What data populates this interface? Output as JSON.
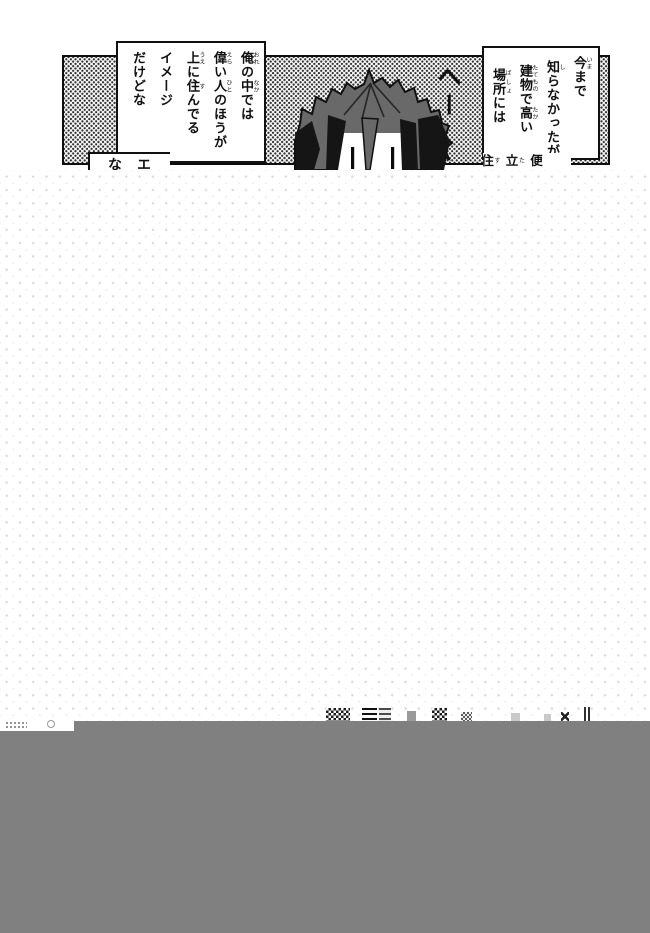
{
  "colors": {
    "gray_bar": "#808080",
    "hair_gray": "#696969",
    "ink": "#111111",
    "tone_dot": "#2e2e2e",
    "overlay_dot": "#dcdcdc",
    "bubble_bg": "#ffffff"
  },
  "bubbles": {
    "right": {
      "columns": [
        {
          "segs": [
            {
              "b": "今",
              "r": "いま"
            },
            {
              "b": "まで"
            }
          ]
        },
        {
          "segs": [
            {
              "b": "知",
              "r": "し"
            },
            {
              "b": "らなかったが"
            }
          ]
        },
        {
          "segs": [
            {
              "b": "建物",
              "r": "たてもの"
            },
            {
              "b": "で"
            },
            {
              "b": "高",
              "r": "たか"
            },
            {
              "b": "い"
            }
          ]
        },
        {
          "segs": [
            {
              "b": "場所",
              "r": "ばしょ"
            },
            {
              "b": "には"
            }
          ]
        }
      ]
    },
    "left": {
      "columns": [
        {
          "segs": [
            {
              "b": "俺",
              "r": "おれ"
            },
            {
              "b": "の"
            },
            {
              "b": "中",
              "r": "なか"
            },
            {
              "b": "では"
            }
          ]
        },
        {
          "segs": [
            {
              "b": "偉",
              "r": "えら"
            },
            {
              "b": "い"
            },
            {
              "b": "人",
              "r": "ひと"
            },
            {
              "b": "のほうが"
            }
          ]
        },
        {
          "segs": [
            {
              "b": "上",
              "r": "うえ"
            },
            {
              "b": "に"
            },
            {
              "b": "住",
              "r": "す"
            },
            {
              "b": "んでる"
            }
          ]
        },
        {
          "segs": [
            {
              "b": "イメージ"
            }
          ]
        },
        {
          "segs": [
            {
              "b": "だけどな"
            }
          ]
        }
      ]
    },
    "bottom_left": {
      "columns": [
        {
          "segs": [
            {
              "b": "エ"
            }
          ]
        },
        {
          "segs": [
            {
              "b": "な"
            }
          ]
        }
      ]
    },
    "bottom_right": {
      "columns": [
        {
          "segs": [
            {
              "b": "便"
            }
          ]
        },
        {
          "segs": [
            {
              "b": "立",
              "r": "た"
            }
          ]
        },
        {
          "segs": [
            {
              "b": "住",
              "r": "す"
            }
          ]
        }
      ]
    }
  },
  "sfx": {
    "hee": "へー"
  },
  "fragments": [
    {
      "name": "checker-a",
      "x": 326,
      "w": 24,
      "h": 13,
      "type": "checker"
    },
    {
      "name": "stripes-a",
      "x": 362,
      "w": 15,
      "h": 13,
      "type": "stripes"
    },
    {
      "name": "stripes-b",
      "x": 379,
      "w": 12,
      "h": 13,
      "type": "stripes-light"
    },
    {
      "name": "smudge",
      "x": 407,
      "w": 9,
      "h": 10,
      "type": "gray"
    },
    {
      "name": "checker-b",
      "x": 432,
      "w": 15,
      "h": 13,
      "type": "checker"
    },
    {
      "name": "checker-c",
      "x": 461,
      "w": 11,
      "h": 9,
      "type": "checker-light"
    },
    {
      "name": "mark-a",
      "x": 511,
      "w": 9,
      "h": 8,
      "type": "gray-light"
    },
    {
      "name": "mark-b",
      "x": 544,
      "w": 7,
      "h": 7,
      "type": "gray-light"
    },
    {
      "name": "xmark",
      "x": 561,
      "w": 8,
      "h": 9,
      "type": "xmark"
    },
    {
      "name": "bars",
      "x": 584,
      "w": 6,
      "h": 14,
      "type": "vbars"
    }
  ]
}
